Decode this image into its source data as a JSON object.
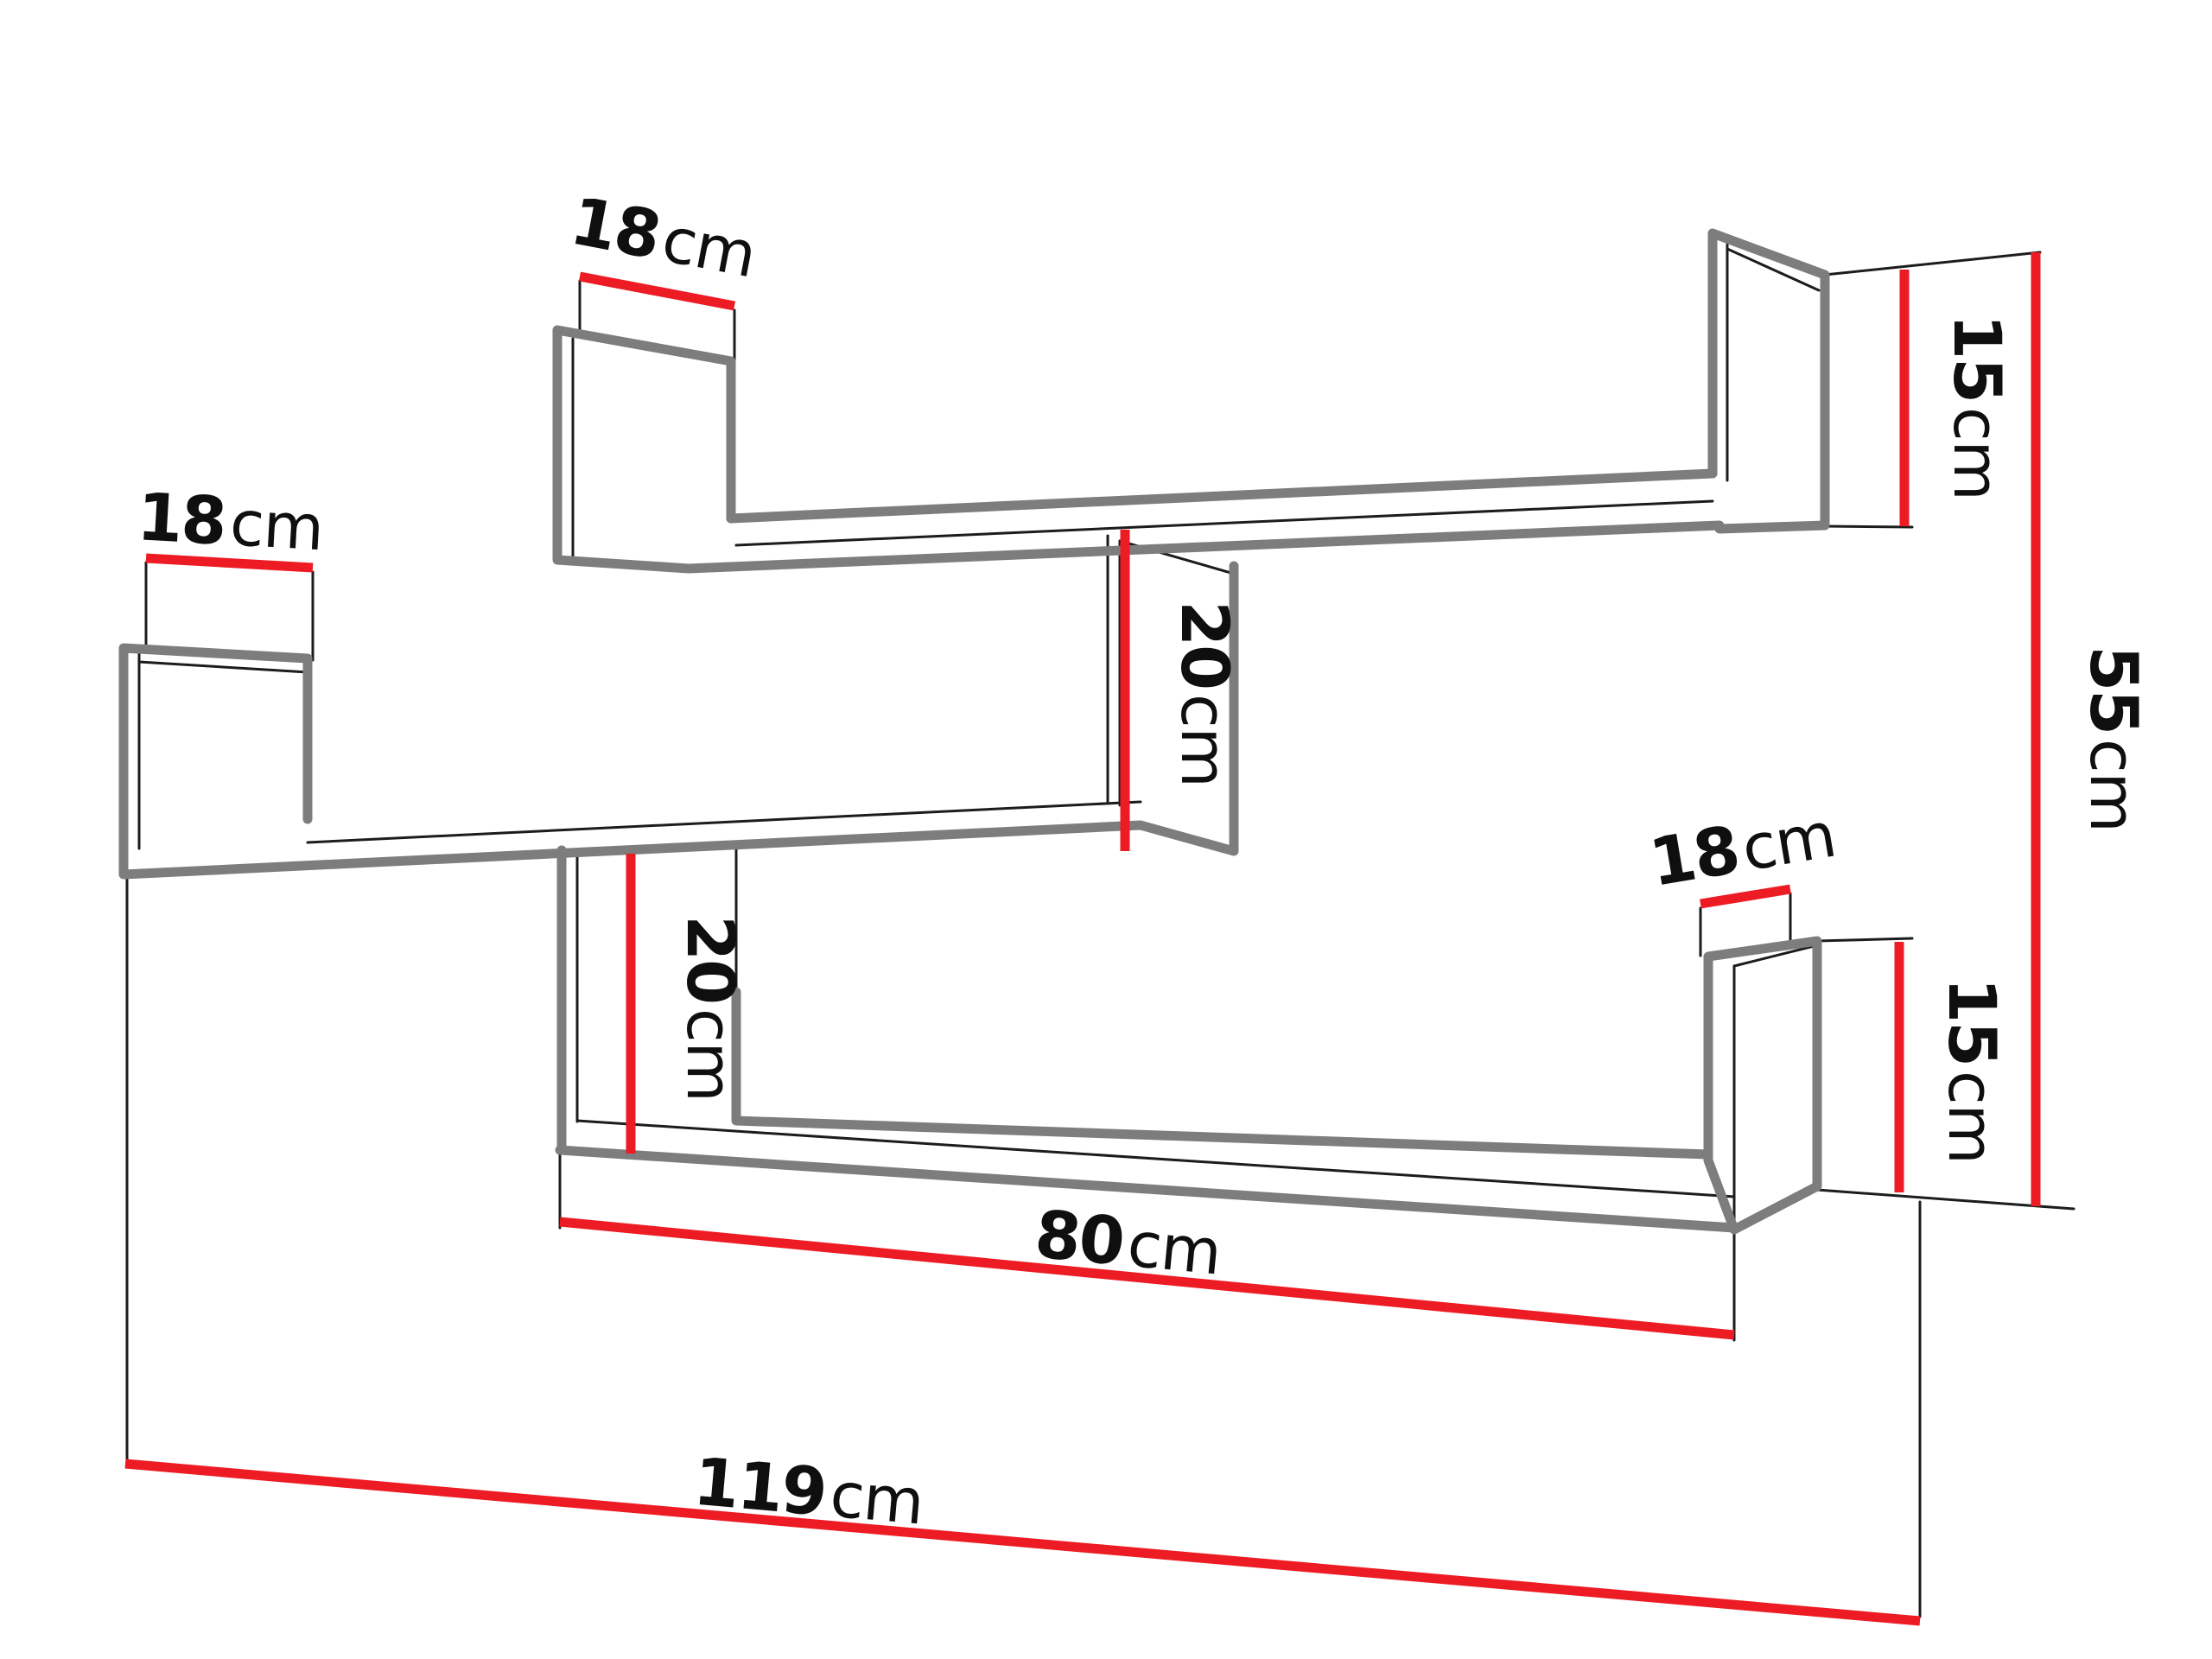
{
  "diagram": {
    "subject": "Wall shelf unit dimension drawing - three zig-zag mounted U-shelves with side panels",
    "background": "#ffffff",
    "units": "cm",
    "colors": {
      "shelf_outline_gray": "#7d7d7d",
      "edge_line_black": "#1c1c1c",
      "dimension_line_red": "#ed1c24",
      "label_text": "#0f0f0f"
    },
    "dimensions": {
      "depth_left_shelf": {
        "value": "18",
        "unit": "cm"
      },
      "depth_top_shelf": {
        "value": "18",
        "unit": "cm"
      },
      "depth_right_shelf": {
        "value": "18",
        "unit": "cm"
      },
      "panel_height_top_right": {
        "value": "15",
        "unit": "cm"
      },
      "panel_height_bottom_right": {
        "value": "15",
        "unit": "cm"
      },
      "connector_height_upper": {
        "value": "20",
        "unit": "cm"
      },
      "connector_height_lower": {
        "value": "20",
        "unit": "cm"
      },
      "total_height": {
        "value": "55",
        "unit": "cm"
      },
      "bottom_shelf_length": {
        "value": "80",
        "unit": "cm"
      },
      "total_length": {
        "value": "119",
        "unit": "cm"
      }
    }
  }
}
